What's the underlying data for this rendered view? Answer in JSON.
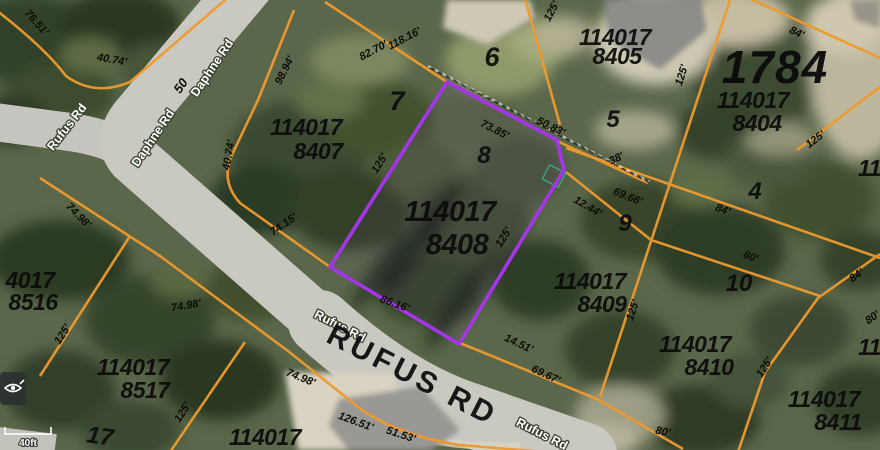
{
  "map": {
    "block_number": "1784",
    "highlight_color": "#a435e8",
    "parcel_line_color": "#ef9a2e",
    "scale_label": "40ft",
    "tool_icon": "eye",
    "roads": {
      "daphne": "Daphne Rd",
      "rufus": "Rufus Rd",
      "rufus_big": "RUFUS RD"
    },
    "lots": [
      "4",
      "5",
      "6",
      "7",
      "8",
      "9",
      "10",
      "17"
    ],
    "parcels": [
      {
        "line1": "114017",
        "line2": "8405"
      },
      {
        "line1": "114017",
        "line2": "8404"
      },
      {
        "line1": "114017",
        "line2": "8407"
      },
      {
        "line1": "114017",
        "line2": "8408"
      },
      {
        "line1": "114017",
        "line2": "8409"
      },
      {
        "line1": "114017",
        "line2": "8410"
      },
      {
        "line1": "114017",
        "line2": "8411"
      },
      {
        "line1": "4017",
        "line2": "8516"
      },
      {
        "line1": "114017",
        "line2": "8517"
      },
      {
        "line1": "114017",
        "line2": ""
      },
      {
        "line1": "1140",
        "line2": ""
      },
      {
        "line1": "114",
        "line2": ""
      }
    ],
    "dimensions": [
      "76.51'",
      "40.74'",
      "50",
      "98.94'",
      "40.74'",
      "82.70'",
      "118.16'",
      "125'",
      "84'",
      "125'",
      "125'",
      "50.83'",
      "73.85'",
      "38'",
      "69.66'",
      "12.44'",
      "74.15'",
      "74.98'",
      "74.98'",
      "74.98'",
      "86.16'",
      "125'",
      "125'",
      "125'",
      "125'",
      "14.51'",
      "69.67'",
      "126.51'",
      "51.53'",
      "84'",
      "80'",
      "84'",
      "125'",
      "125'",
      "80'",
      "80'"
    ]
  }
}
